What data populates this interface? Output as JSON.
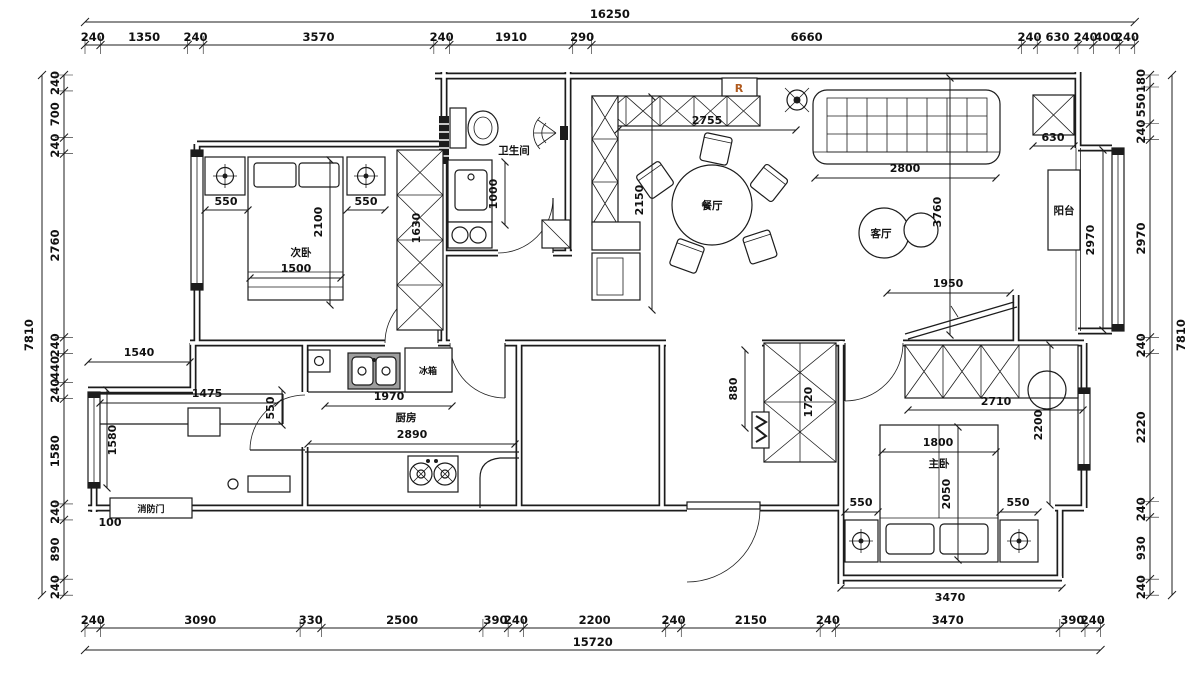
{
  "title": "residential floor plan",
  "colors": {
    "line": "#1c1c1c",
    "riser_label": "#b05a1e",
    "sink_gray": "#9e9e9e",
    "background": "#ffffff"
  },
  "rooms": {
    "bedroom2": "次卧",
    "bathroom": "卫生间",
    "dining": "餐厅",
    "living": "客厅",
    "balcony": "阳台",
    "kitchen": "厨房",
    "master": "主卧",
    "fridge": "冰箱",
    "fire_door": "消防门",
    "riser": "R"
  },
  "dimensions": {
    "top": {
      "total": "16250",
      "segments": [
        240,
        1350,
        240,
        3570,
        240,
        1910,
        290,
        6660,
        240,
        630,
        240,
        400,
        240
      ]
    },
    "bottom": {
      "total": "15720",
      "segments": [
        240,
        3090,
        330,
        2500,
        390,
        240,
        2200,
        240,
        2150,
        240,
        3470,
        390,
        240
      ]
    },
    "left": {
      "total": "7810",
      "segments": [
        240,
        700,
        240,
        2760,
        240,
        440,
        240,
        1580,
        240,
        890,
        240
      ]
    },
    "right": {
      "total": "7810",
      "segments": [
        180,
        550,
        240,
        2970,
        240,
        2220,
        240,
        930,
        240
      ]
    }
  },
  "interior_dims": {
    "bedroom2": {
      "nightstand_left": "550",
      "nightstand_right": "550",
      "bed_length": "2100",
      "bed_width": "1500",
      "wardrobe": "1630"
    },
    "bathroom": {
      "vanity": "1000"
    },
    "dining": {
      "width": "2755",
      "depth": "2150"
    },
    "living": {
      "sofa": "2800",
      "depth": "3760",
      "passage": "1950",
      "column": "630"
    },
    "balcony": {
      "length": "2970"
    },
    "study": {
      "top": "1540",
      "desk": "1475",
      "desk_depth": "550",
      "depth": "1580",
      "offset": "100"
    },
    "kitchen": {
      "counter": "1970",
      "width": "2890"
    },
    "hall": {
      "corridor": "880",
      "cabinet": "1720"
    },
    "master": {
      "wardrobe": "2710",
      "entry_depth": "2200",
      "bed_width": "1800",
      "bed_length": "2050",
      "nightstand_left": "550",
      "nightstand_right": "550",
      "width": "3470"
    }
  }
}
